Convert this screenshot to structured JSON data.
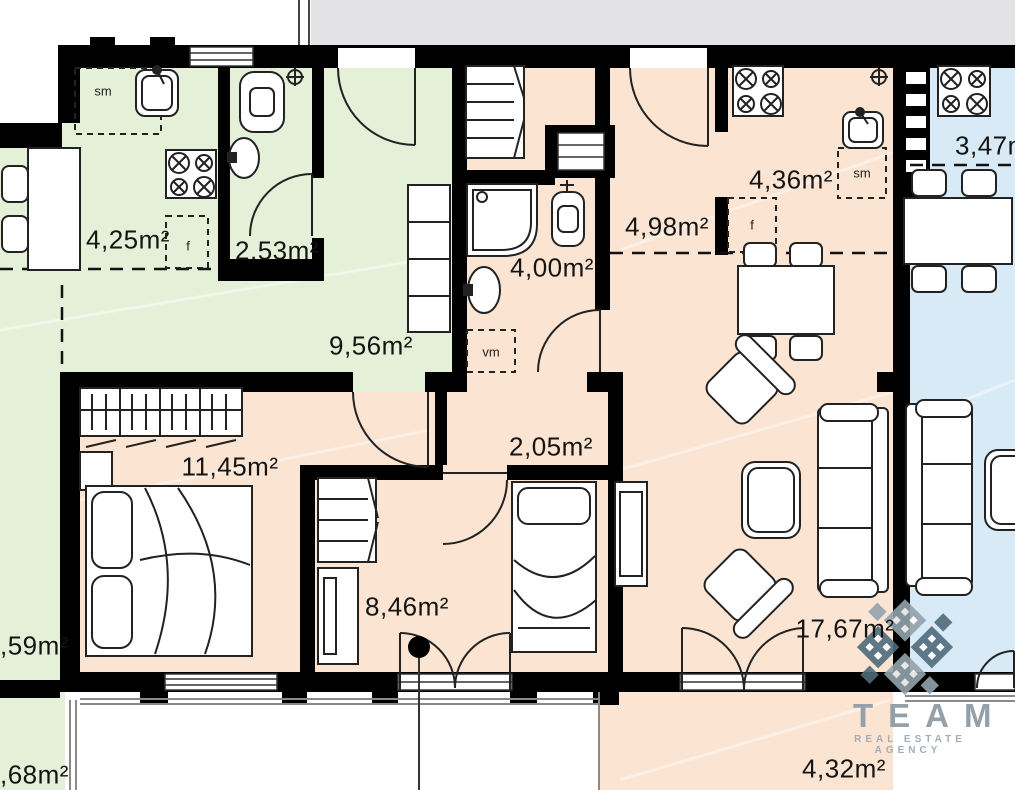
{
  "meta": {
    "kind": "apartment-floor-plan"
  },
  "colors": {
    "wall": "#000000",
    "green": "#e4f0d7",
    "peach": "#fbe4d2",
    "blue": "#d8eaf5",
    "corridor": "#e3e3e5",
    "line": "#222222",
    "railing": "#8a8a8a",
    "watermark_light": "#93a2ad",
    "watermark_dark": "#4f6b7c",
    "watermark_text": "#95a1a9"
  },
  "units": {
    "green": {
      "kitchen": "4,25m²",
      "bathroom": "2,53m²",
      "hall": "9,56m²",
      "room_partial": ",59m²",
      "balcony_partial": ",68m²"
    },
    "peach": {
      "bathroom": "4,00m²",
      "entry": "4,98m²",
      "kitchen": "4,36m²",
      "corridor": "2,05m²",
      "bedroom": "11,45m²",
      "room": "8,46m²",
      "living": "17,67m²",
      "balcony": "4,32m²"
    },
    "blue": {
      "kitchen": "3,47m²"
    }
  },
  "fixture_labels": {
    "green_closet": "sm",
    "green_fridge": "f",
    "washer": "vm",
    "peach_closet": "sm",
    "peach_fridge": "f"
  },
  "watermark": {
    "name": "TEAM",
    "tagline": "REAL ESTATE AGENCY"
  }
}
